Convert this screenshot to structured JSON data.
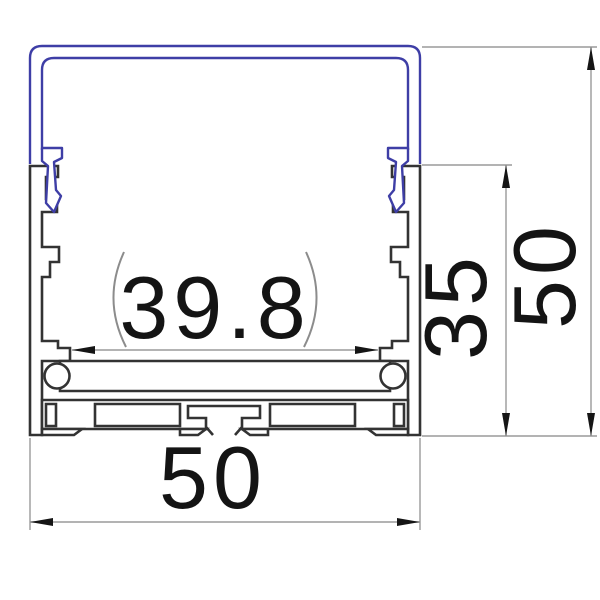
{
  "page": {
    "background": "#ffffff",
    "description": "CAD cross-section drawing of an aluminum LED strip profile with plastic diffuser cover and dimension annotations"
  },
  "profile": {
    "cover_outline_color": "#3e3ea6",
    "body_outline_color": "#333333"
  },
  "dimensions": {
    "inner_width": "39.8",
    "inner_height": "35",
    "overall_height": "50",
    "overall_width": "50",
    "line_color": "#9a9a9a",
    "paren_color": "#8c8c8c",
    "arrow_color": "#151515",
    "text_color": "#141414"
  }
}
